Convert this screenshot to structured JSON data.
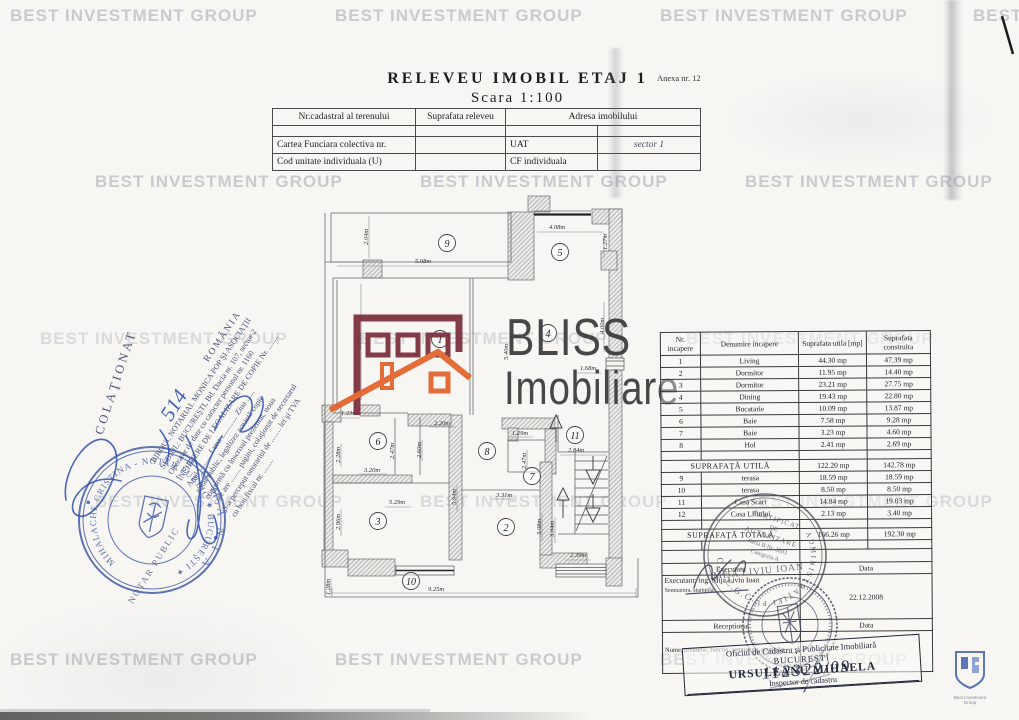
{
  "watermark": {
    "text": "BEST INVESTMENT GROUP"
  },
  "page": {
    "anexa": "Anexa nr. 12",
    "title": "RELEVEU IMOBIL ETAJ 1",
    "subtitle": "Scara 1:100"
  },
  "top_table": {
    "nr_cadastral": "Nr.cadastral al terenului",
    "suprafata_releveu": "Suprafata releveu",
    "adresa": "Adresa imobilului",
    "cartea": "Cartea Funciara colectiva nr.",
    "uat": "UAT",
    "sector": "sector 1",
    "cod": "Cod unitate individuala (U)",
    "cf": "CF individuala"
  },
  "logo": {
    "brand": "BLISS",
    "sub": "Imobiliare",
    "maroon": "#7b2f3a",
    "orange": "#e2622b",
    "ink": "#3a3a3c"
  },
  "colors": {
    "notary_blue": "#3d57a5",
    "handwriting_blue": "#2e4fae",
    "stamp_gray": "#4b4b55",
    "ocpi_ink": "#3d4258"
  },
  "plan": {
    "rooms": {
      "r1": "1",
      "r2": "2",
      "r3": "3",
      "r4": "4",
      "r5": "5",
      "r6": "6",
      "r7": "7",
      "r8": "8",
      "r9": "9",
      "r10": "10",
      "r11": "11"
    },
    "dims": {
      "d204": "2.04m",
      "d508": "5.08m",
      "d408": "4.08m",
      "d127": "1.27m",
      "d538": "5.38m",
      "d540": "5.40m",
      "d400": "4.00m",
      "d168": "1.68m",
      "d123": "1.23m",
      "d220": "2.20m",
      "d129": "1.29m",
      "d284": "2.84m",
      "d228": "2.28m",
      "d247a": "2.47m",
      "d260": "2.60m",
      "d247b": "2.47m",
      "d320": "3.20m",
      "d594": "5.94m",
      "d331": "3.31m",
      "d529": "5.29m",
      "d296": "2.96m",
      "d308": "3.08m",
      "d304": "3.04m",
      "d239": "2.39m",
      "d128": "1.28m",
      "d925": "9.25m"
    }
  },
  "room_table": {
    "headers": [
      "Nr. incapere",
      "Denumire incapere",
      "Suprafata utila [mp]",
      "Suprafata construita"
    ],
    "rows": [
      [
        "1",
        "Living",
        "44.30 mp",
        "47.39 mp"
      ],
      [
        "2",
        "Dormitor",
        "11.95 mp",
        "14.40 mp"
      ],
      [
        "3",
        "Dormitor",
        "23.21 mp",
        "27.75 mp"
      ],
      [
        "4",
        "Dining",
        "19.43 mp",
        "22.80 mp"
      ],
      [
        "5",
        "Bucatarie",
        "10.09 mp",
        "13.87 mp"
      ],
      [
        "6",
        "Baie",
        "7.58 mp",
        "9.28 mp"
      ],
      [
        "7",
        "Baie",
        "3.23 mp",
        "4.60 mp"
      ],
      [
        "8",
        "Hol",
        "2.41 mp",
        "2.69 mp"
      ]
    ],
    "utila_label": "SUPRAFAŢĂ UTILĂ",
    "utila_values": {
      "u1": "122.20 mp",
      "u2": "142.78 mp"
    },
    "rows2": [
      [
        "9",
        "terasa",
        "18.59 mp",
        "18.59 mp"
      ],
      [
        "10",
        "terasa",
        "8.50 mp",
        "8.50 mp"
      ],
      [
        "11",
        "Casa Scari",
        "14.84 mp",
        "19.03 mp"
      ],
      [
        "12",
        "Casa Liftului",
        "2.13 mp",
        "3.40 mp"
      ]
    ],
    "totala_label": "SUPRAFAŢĂ TOTALĂ",
    "totala_values": {
      "t1": "166.26 mp",
      "t2": "192.30 mp"
    },
    "executant_label": "Executant",
    "data_label": "Data",
    "executant_name": "Executant: ing. Mija Liviu Ioan",
    "semnatura_label": "Semnatura, stampila",
    "date_value": "22.12.2008",
    "receptionat_label": "Receptionat",
    "data_label2": "Data",
    "nume_label": "Nume, prenume, functie, semnatura, stampila"
  },
  "stamps": {
    "mija": {
      "ring": "ADMINISTRAŢIEI  PUBLICE",
      "line1": "CERTIFICAT",
      "line2": "DE",
      "line3": "AUTORIZARE",
      "line4": "Seria B Nr. 3203",
      "line5": "Categoria A",
      "name": "MIJA LIVIU IOAN",
      "bottom": "O.N.C.G.C."
    },
    "notary": {
      "country": "R O M Â N I A",
      "ring": "MIHALACHE  CRISTINA  -  NOTAR  PUBLIC  ✦  BUCUREŞTI  ✦"
    }
  },
  "ocpi_box": {
    "l1": "Oficiul de Cadastru şi Publicitate Imobiliară",
    "l2": "BUCUREŞTI",
    "l3": "URSULEANU MIHAELA",
    "l4": "Inspector de cadastru",
    "number": "112322/09"
  },
  "notary_block": {
    "lines": [
      "ROMÂNIA",
      "BIROUL NOTARIAL MONICA POP ŞI ASOCIAŢII",
      "SEDIUL: BUCUREŞTI, Bd. Dacia nr. 107, sector 2",
      "Operator de date cu caracter personal nr. 1160",
      "ÎNCHEIERE DE LEGALIZARE DE COPIE Nr. ........",
      "Anul ..........  Luna .............  Ziua ......",
      "notar public, legalizez această copie",
      "conformă cu înscrisul prezentat, noua",
      "care are ........ pagini, colaţionat de secretarul",
      "S-a perceput onorariul de ........ lei şi TVA",
      "cu bon fiscal nr. ........"
    ],
    "colationat": "COLAŢIONAT",
    "notar_fragment": "NOTAR PUBLIC",
    "hand_number": "514"
  },
  "big_logo": {
    "caption1": "Best Investment",
    "caption2": "Group"
  }
}
